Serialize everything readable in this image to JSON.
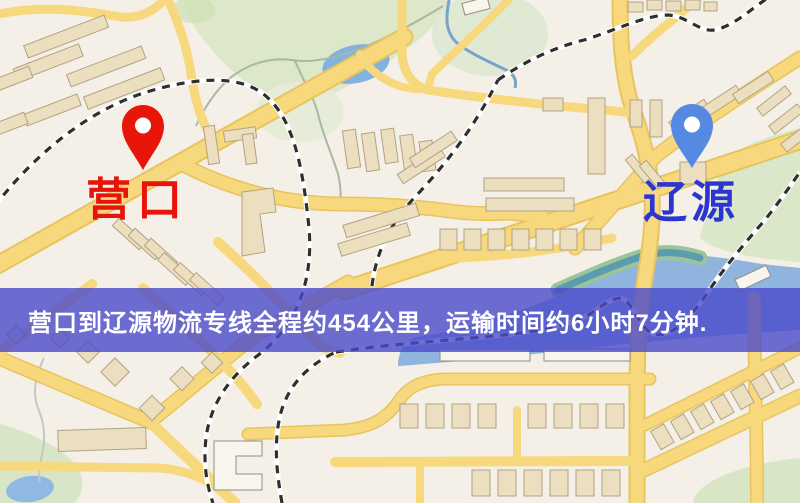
{
  "map": {
    "origin": {
      "label": "营口",
      "label_color": "#e8130a",
      "pin_color": "#e8150a"
    },
    "destination": {
      "label": "辽源",
      "label_color": "#2b36cf",
      "pin_color": "#568ae2"
    },
    "colors": {
      "background": "#f4f0e7",
      "road": "#f7d87d",
      "road_casing": "#e8c45f",
      "park_green": "#dce8c9",
      "water_blue": "#8fb4de",
      "railway_dark": "#2f2f2f",
      "building_tan": "#ebdfbf"
    }
  },
  "banner": {
    "text": "营口到辽源物流专线全程约454公里，运输时间约6小时7分钟.",
    "distance_text": "约454公里",
    "duration_text": "约6小时7分钟",
    "background_color": "#4a4aca",
    "text_color": "#ffffff"
  }
}
